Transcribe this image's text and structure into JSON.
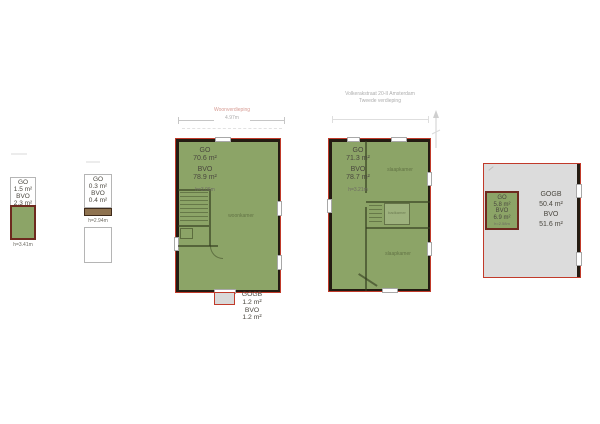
{
  "document": {
    "background": "#ffffff"
  },
  "colors": {
    "area_green": "#8CA467",
    "area_gray": "#DBDBDB",
    "plan_border_red": "#C13A2A",
    "wall_dark": "#241B12",
    "shed_border_dark_red": "#6E2A1F"
  },
  "headers": {
    "sleeping_floor_address_line1": "Volkerakstraat 20-II Amsterdam",
    "sleeping_floor_address_line2": "Tweede verdieping",
    "living_floor_title": "Woonverdieping",
    "living_floor_width_dim": "4.97m"
  },
  "plan_attic_storage": {
    "go_label": "GO",
    "go_value": "1.5 m²",
    "bvo_label": "BVO",
    "bvo_value": "2.3 m²",
    "height_note": "h=3.41m"
  },
  "plan_attic_access": {
    "go_label": "GO",
    "go_value": "0.3 m²",
    "bvo_label": "BVO",
    "bvo_value": "0.4 m²",
    "height_note": "h=2.94m"
  },
  "plan_living_floor": {
    "go_label": "GO",
    "go_value": "70.6 m²",
    "bvo_label": "BVO",
    "bvo_value": "78.9 m²",
    "height_note": "h=3.06m",
    "room_label": "woonkamer"
  },
  "balcony": {
    "gogb_label": "GOGB",
    "gogb_value": "1.2 m²",
    "bvo_label": "BVO",
    "bvo_value": "1.2 m²"
  },
  "plan_sleeping_floor": {
    "go_label": "GO",
    "go_value": "71.3 m²",
    "bvo_label": "BVO",
    "bvo_value": "78.7 m²",
    "height_note": "h=3.21m",
    "room_label_top": "slaapkamer",
    "room_label_mid": "badkamer",
    "room_label_bottom": "slaapkamer"
  },
  "roof_terrace": {
    "gogb_label": "GOGB",
    "gogb_value": "50.4 m²",
    "bvo_label": "BVO",
    "bvo_value": "51.6 m²"
  },
  "roof_shed": {
    "go_label": "GO",
    "go_value": "5.8 m²",
    "bvo_label": "BVO",
    "bvo_value": "6.9 m²",
    "height_note": "h=2.58m"
  }
}
